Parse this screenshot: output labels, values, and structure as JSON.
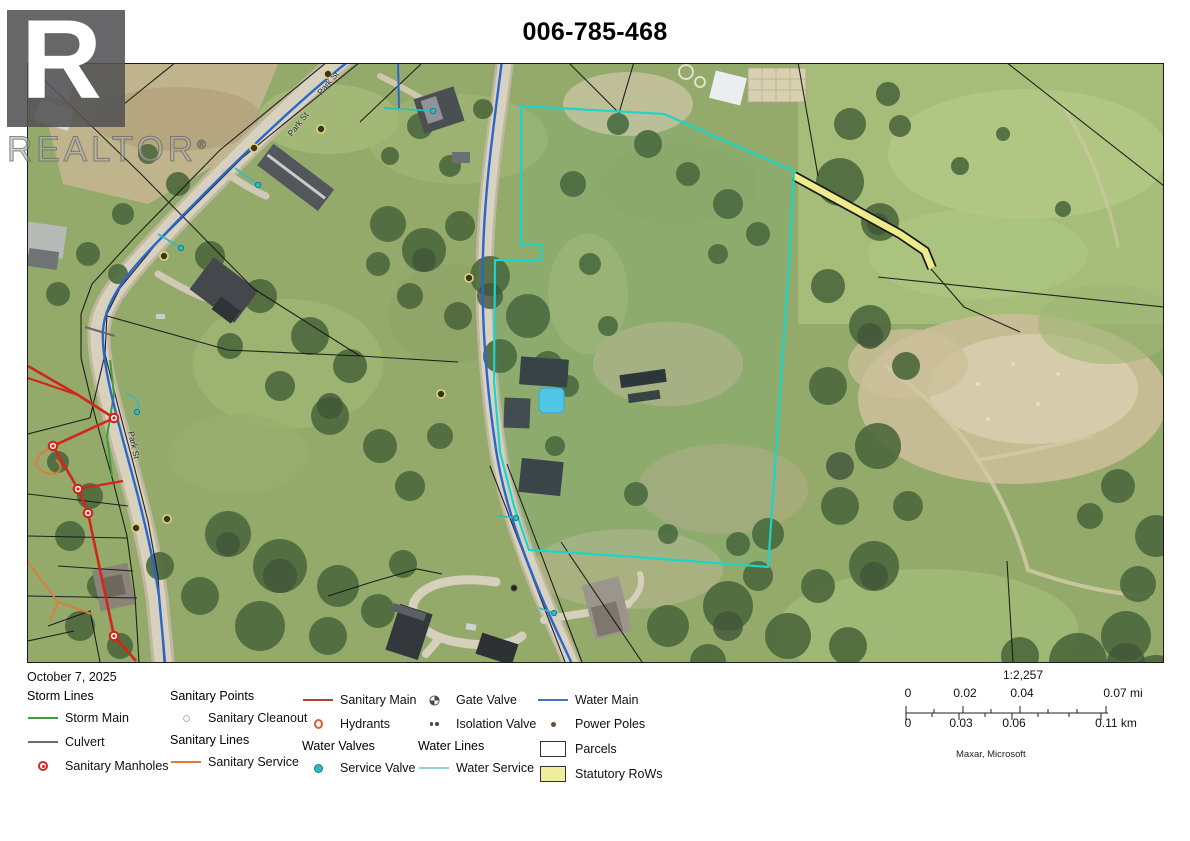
{
  "title": "006-785-468",
  "watermark": {
    "letter": "R",
    "brand": "REALTOR",
    "reg": "®"
  },
  "map": {
    "date": "October 7, 2025",
    "highlight_parcel_color": "#1bd6c7",
    "street_labels": [
      {
        "text": "Park St"
      },
      {
        "text": "Park St"
      },
      {
        "text": "Park St"
      }
    ]
  },
  "legend": {
    "columns": [
      {
        "entries": [
          {
            "type": "header",
            "label": "Storm Lines"
          },
          {
            "type": "item",
            "label": "Storm Main",
            "icon": "storm-main-line-swatch",
            "color": "#3f9b3f"
          },
          {
            "type": "item",
            "label": "Culvert",
            "icon": "culvert-line-swatch",
            "color": "#6e6e6e"
          },
          {
            "type": "item",
            "label": "Sanitary Manholes",
            "icon": "sanitary-manhole-icon",
            "color": "#d3261b"
          }
        ]
      },
      {
        "entries": [
          {
            "type": "header",
            "label": "Sanitary Points"
          },
          {
            "type": "item",
            "label": "Sanitary Cleanout",
            "icon": "sanitary-cleanout-icon",
            "color": "#e4a79c"
          },
          {
            "type": "header",
            "label": "Sanitary Lines"
          },
          {
            "type": "item",
            "label": "Sanitary Service",
            "icon": "sanitary-service-line-swatch",
            "color": "#e07a38"
          }
        ]
      },
      {
        "entries": [
          {
            "type": "item",
            "label": "Sanitary Main",
            "icon": "sanitary-main-line-swatch",
            "color": "#b24236"
          },
          {
            "type": "item",
            "label": "Hydrants",
            "icon": "hydrant-icon",
            "color": "#dd5e2d"
          },
          {
            "type": "header",
            "label": "Water Valves"
          },
          {
            "type": "item",
            "label": "Service Valve",
            "icon": "service-valve-icon",
            "color": "#26a2a0"
          }
        ]
      },
      {
        "entries": [
          {
            "type": "item",
            "label": "Gate Valve",
            "icon": "gate-valve-icon",
            "color": "#4a4a4a"
          },
          {
            "type": "item",
            "label": "Isolation Valve",
            "icon": "isolation-valve-icon",
            "color": "#4a4a4a"
          },
          {
            "type": "header",
            "label": "Water Lines"
          },
          {
            "type": "item",
            "label": "Water Service",
            "icon": "water-service-line-swatch",
            "color": "#93d2d8"
          }
        ]
      },
      {
        "entries": [
          {
            "type": "item",
            "label": "Water Main",
            "icon": "water-main-line-swatch",
            "color": "#3a76c4"
          },
          {
            "type": "item",
            "label": "Power Poles",
            "icon": "power-pole-icon",
            "color": "#6b4a2e"
          },
          {
            "type": "item",
            "label": "Parcels",
            "icon": "parcel-swatch",
            "color": "#ffffff"
          },
          {
            "type": "item",
            "label": "Statutory RoWs",
            "icon": "statutory-row-swatch",
            "color": "#f0ee9e"
          }
        ]
      }
    ]
  },
  "scalebar": {
    "ratio": "1:2,257",
    "mi": {
      "t0": "0",
      "t1": "0.02",
      "t2": "0.04",
      "t3": "0.07 mi"
    },
    "km": {
      "t0": "0",
      "t1": "0.03",
      "t2": "0.06",
      "t3": "0.11 km"
    },
    "attribution": "Maxar, Microsoft"
  }
}
